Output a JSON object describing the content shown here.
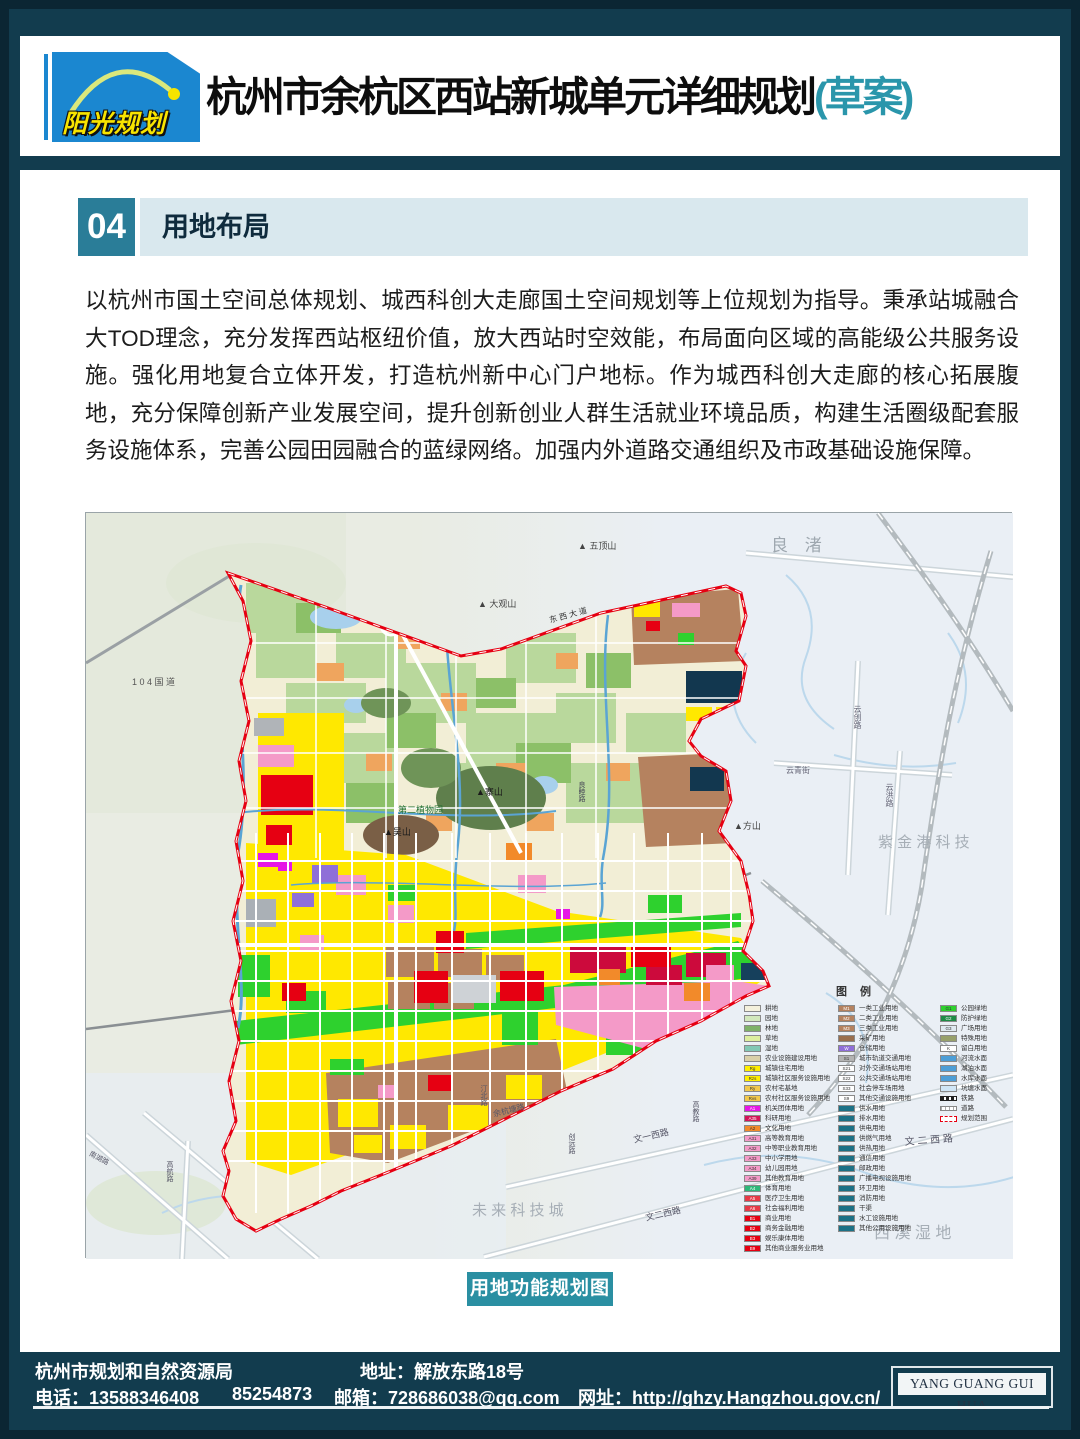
{
  "header": {
    "logo_text": "阳光规划",
    "title": "杭州市余杭区西站新城单元详细规划",
    "title_suffix": "(草案)",
    "accent_teal": "#2a96ab",
    "logo_blue": "#1b87d0",
    "logo_yellow": "#f8e400"
  },
  "section": {
    "number": "04",
    "title": "用地布局"
  },
  "body_text": "以杭州市国土空间总体规划、城西科创大走廊国土空间规划等上位规划为指导。秉承站城融合大TOD理念，充分发挥西站枢纽价值，放大西站时空效能，布局面向区域的高能级公共服务设施。强化用地复合立体开发，打造杭州新中心门户地标。作为城西科创大走廊的核心拓展腹地，充分保障创新产业发展空间，提升创新创业人群生活就业环境品质，构建生活圈级配套服务设施体系，完善公园田园融合的蓝绿网络。加强内外道路交通组织及市政基础设施保障。",
  "map": {
    "caption": "用地功能规划图",
    "legend_title": "图 例",
    "boundary_color": "#e60012",
    "legend_columns": [
      [
        {
          "c": "#f4f1dc",
          "t": "耕地",
          "code": ""
        },
        {
          "c": "#d2e8bc",
          "t": "园地",
          "code": ""
        },
        {
          "c": "#7fb269",
          "t": "林地",
          "code": ""
        },
        {
          "c": "#dcee9e",
          "t": "草地",
          "code": ""
        },
        {
          "c": "#82c8b4",
          "t": "湿地",
          "code": ""
        },
        {
          "c": "#d9d0a8",
          "t": "农业设施建设用地",
          "code": ""
        },
        {
          "c": "#ffee00",
          "t": "城镇住宅用地",
          "code": "Rg"
        },
        {
          "c": "#ffee00",
          "t": "城镇社区服务设施用地",
          "code": "Rzs"
        },
        {
          "c": "#f2c94c",
          "t": "农村宅基地",
          "code": "Ry"
        },
        {
          "c": "#f2c94c",
          "t": "农村社区服务设施用地",
          "code": "Rvs"
        },
        {
          "c": "#e616e6",
          "t": "机关团体用地",
          "code": "A1"
        },
        {
          "c": "#d4145a",
          "t": "科研用地",
          "code": "A35"
        },
        {
          "c": "#f28a2a",
          "t": "文化用地",
          "code": "A2"
        },
        {
          "c": "#f49ac8",
          "t": "高等教育用地",
          "code": "A31"
        },
        {
          "c": "#f49ac8",
          "t": "中等职业教育用地",
          "code": "A32"
        },
        {
          "c": "#f49ac8",
          "t": "中小学用地",
          "code": "A33"
        },
        {
          "c": "#f49ac8",
          "t": "幼儿园用地",
          "code": "A34"
        },
        {
          "c": "#f49ac8",
          "t": "其他教育用地",
          "code": "A39"
        },
        {
          "c": "#2eb87a",
          "t": "体育用地",
          "code": "A4"
        },
        {
          "c": "#e63946",
          "t": "医疗卫生用地",
          "code": "A5"
        },
        {
          "c": "#e63946",
          "t": "社会福利用地",
          "code": "A6"
        },
        {
          "c": "#e60012",
          "t": "商业用地",
          "code": "B1"
        },
        {
          "c": "#e60012",
          "t": "商务金融用地",
          "code": "B2"
        },
        {
          "c": "#e60012",
          "t": "娱乐康体用地",
          "code": "B3"
        },
        {
          "c": "#e60012",
          "t": "其他商业服务业用地",
          "code": "B9"
        }
      ],
      [
        {
          "c": "#b5825f",
          "t": "一类工业用地",
          "code": "M1"
        },
        {
          "c": "#b5825f",
          "t": "二类工业用地",
          "code": "M2"
        },
        {
          "c": "#b5825f",
          "t": "三类工业用地",
          "code": "M3"
        },
        {
          "c": "#9a6f4e",
          "t": "采矿用地",
          "code": ""
        },
        {
          "c": "#8f6fd8",
          "t": "仓储用地",
          "code": "W"
        },
        {
          "c": "#b3b3b3",
          "t": "城市轨道交通用地",
          "code": "S1"
        },
        {
          "c": "#ffffff",
          "t": "对外交通场站用地",
          "code": "S21"
        },
        {
          "c": "#ffffff",
          "t": "公共交通场站用地",
          "code": "S22"
        },
        {
          "c": "#ffffff",
          "t": "社会停车场用地",
          "code": "S33"
        },
        {
          "c": "#ffffff",
          "t": "其他交通设施用地",
          "code": "S9"
        },
        {
          "c": "#1c7186",
          "t": "供水用地",
          "code": ""
        },
        {
          "c": "#1c7186",
          "t": "排水用地",
          "code": ""
        },
        {
          "c": "#1c7186",
          "t": "供电用地",
          "code": ""
        },
        {
          "c": "#1c7186",
          "t": "供燃气用地",
          "code": ""
        },
        {
          "c": "#1c7186",
          "t": "供热用地",
          "code": ""
        },
        {
          "c": "#1c7186",
          "t": "通信用地",
          "code": ""
        },
        {
          "c": "#1c7186",
          "t": "邮政用地",
          "code": ""
        },
        {
          "c": "#1c7186",
          "t": "广播电视设施用地",
          "code": ""
        },
        {
          "c": "#1c7186",
          "t": "环卫用地",
          "code": ""
        },
        {
          "c": "#1c7186",
          "t": "消防用地",
          "code": ""
        },
        {
          "c": "#1c7186",
          "t": "干渠",
          "code": ""
        },
        {
          "c": "#1c7186",
          "t": "水工设施用地",
          "code": ""
        },
        {
          "c": "#1c7186",
          "t": "其他公用设施用地",
          "code": ""
        }
      ],
      [
        {
          "c": "#2ed12e",
          "t": "公园绿地",
          "code": "G1"
        },
        {
          "c": "#1f8c46",
          "t": "防护绿地",
          "code": "G2"
        },
        {
          "c": "#dfe9f0",
          "t": "广场用地",
          "code": "G3"
        },
        {
          "c": "#97a06b",
          "t": "特殊用地",
          "code": ""
        },
        {
          "c": "#ffffff",
          "t": "留白用地",
          "code": "K"
        },
        {
          "c": "#4d9ed6",
          "t": "河流水面",
          "code": ""
        },
        {
          "c": "#4d9ed6",
          "t": "湖泊水面",
          "code": ""
        },
        {
          "c": "#4d9ed6",
          "t": "水库水面",
          "code": ""
        },
        {
          "c": "#cfe5f5",
          "t": "坑塘水面",
          "code": ""
        },
        {
          "sym": "rail",
          "t": "铁路"
        },
        {
          "sym": "road",
          "t": "道路"
        },
        {
          "sym": "bound",
          "t": "规划范围"
        }
      ]
    ],
    "labels": [
      {
        "t": "良 渚",
        "x": 685,
        "y": 18,
        "s": 17,
        "c": "#9fa8b0",
        "ls": 6
      },
      {
        "t": "▲ 五顶山",
        "x": 492,
        "y": 26,
        "s": 9,
        "c": "#444"
      },
      {
        "t": "▲ 大观山",
        "x": 392,
        "y": 84,
        "s": 9,
        "c": "#444"
      },
      {
        "t": "1 0 4 国 道",
        "x": 46,
        "y": 162,
        "s": 9,
        "c": "#555"
      },
      {
        "t": "东 西 大 道",
        "x": 462,
        "y": 102,
        "s": 8,
        "c": "#333",
        "r": -15
      },
      {
        "t": "▲寨山",
        "x": 390,
        "y": 272,
        "s": 9,
        "c": "#1a1a1a"
      },
      {
        "t": "第二植物园",
        "x": 312,
        "y": 290,
        "s": 9,
        "c": "#1f6e30"
      },
      {
        "t": "▲吴山",
        "x": 298,
        "y": 312,
        "s": 9,
        "c": "#1a1a1a"
      },
      {
        "t": "▲方山",
        "x": 648,
        "y": 306,
        "s": 9,
        "c": "#444"
      },
      {
        "t": "云创路",
        "x": 766,
        "y": 192,
        "s": 8,
        "c": "#667",
        "v": 1
      },
      {
        "t": "云青街",
        "x": 700,
        "y": 252,
        "s": 8,
        "c": "#667"
      },
      {
        "t": "云洪路",
        "x": 798,
        "y": 270,
        "s": 8,
        "c": "#667",
        "v": 1
      },
      {
        "t": "紫 金 港 科 技",
        "x": 792,
        "y": 318,
        "s": 15,
        "c": "#a6aeb6"
      },
      {
        "t": "良睦路",
        "x": 490,
        "y": 268,
        "s": 7,
        "c": "#445",
        "v": 1
      },
      {
        "t": "余杭塘路",
        "x": 406,
        "y": 596,
        "s": 8,
        "c": "#556",
        "r": -14
      },
      {
        "t": "汀北路",
        "x": 392,
        "y": 572,
        "s": 7,
        "c": "#556",
        "v": 1
      },
      {
        "t": "创远路",
        "x": 480,
        "y": 620,
        "s": 7,
        "c": "#556",
        "v": 1
      },
      {
        "t": "高教路",
        "x": 604,
        "y": 588,
        "s": 7,
        "c": "#556",
        "v": 1
      },
      {
        "t": "南湖路",
        "x": 6,
        "y": 636,
        "s": 7,
        "c": "#556",
        "r": 28
      },
      {
        "t": "高航路",
        "x": 78,
        "y": 648,
        "s": 7,
        "c": "#556",
        "v": 1
      },
      {
        "t": "文一西路",
        "x": 546,
        "y": 620,
        "s": 9,
        "c": "#556",
        "r": -13
      },
      {
        "t": "文二西路",
        "x": 558,
        "y": 698,
        "s": 9,
        "c": "#556",
        "r": -13
      },
      {
        "t": "文 二 西 路",
        "x": 818,
        "y": 620,
        "s": 10,
        "c": "#556",
        "r": -4
      },
      {
        "t": "未 来 科 技 城",
        "x": 386,
        "y": 686,
        "s": 15,
        "c": "#a6aeb6"
      },
      {
        "t": "西 溪 湿 地",
        "x": 788,
        "y": 706,
        "s": 16,
        "c": "#a6aeb6"
      }
    ]
  },
  "footer": {
    "org": "杭州市规划和自然资源局",
    "address": "地址：解放东路18号",
    "phone": "电话：13588346408",
    "phone2": "85254873",
    "email": "邮箱：728686038@qq.com",
    "website": "网址：http://ghzy.Hangzhou.gov.cn/",
    "brand": "YANG GUANG GUI HUA"
  }
}
